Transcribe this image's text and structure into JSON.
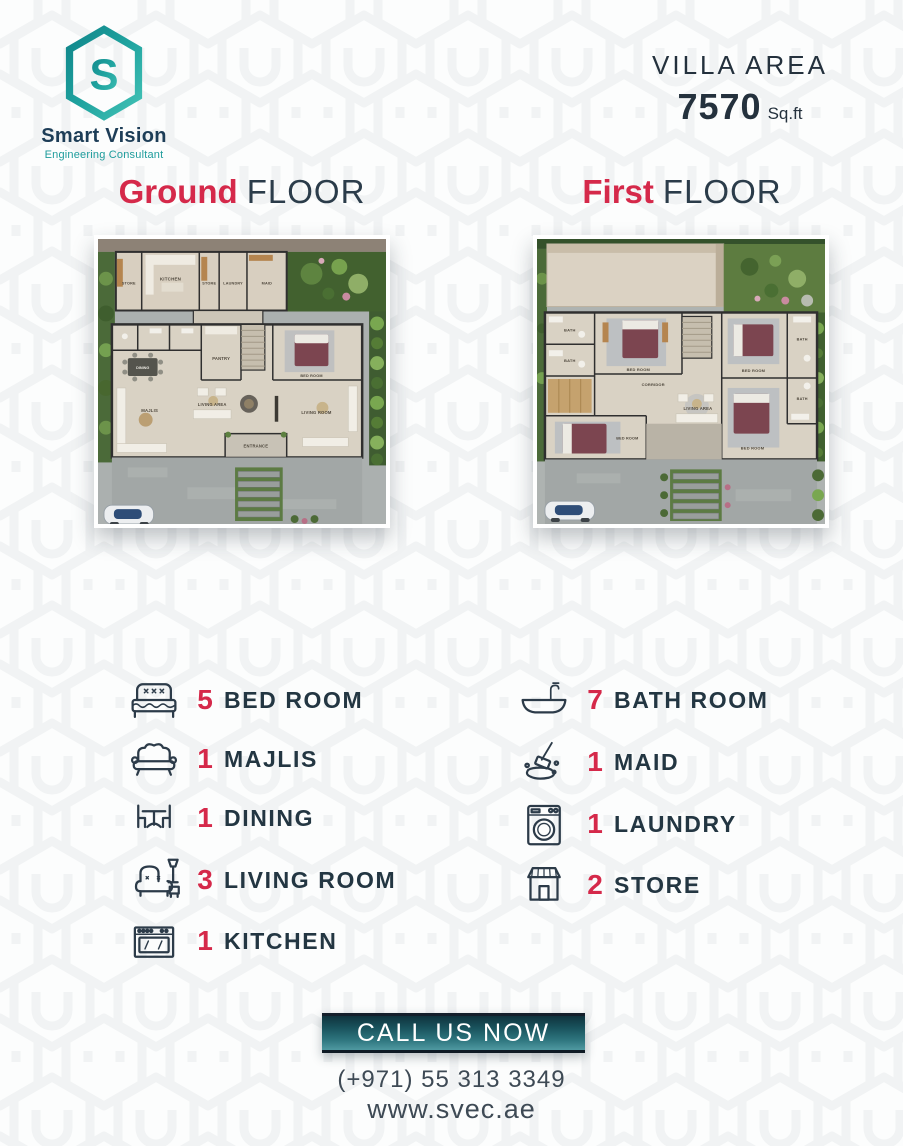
{
  "brand": {
    "name": "Smart Vision",
    "tagline": "Engineering Consultant",
    "logo_letter": "S"
  },
  "header": {
    "area_label": "VILLA AREA",
    "area_value": "7570",
    "area_unit": "Sq.ft"
  },
  "sections": {
    "ground": {
      "highlight": "Ground",
      "rest": "FLOOR"
    },
    "first": {
      "highlight": "First",
      "rest": "FLOOR"
    }
  },
  "ground_plan": {
    "labels": {
      "store_a": "STORE",
      "kitchen": "KITCHEN",
      "store_b": "STORE",
      "laundry": "LAUNDRY",
      "maid": "MAID",
      "pantry": "PANTRY",
      "dining": "DINING",
      "majlis": "MAJLIS",
      "living_area": "LIVING AREA",
      "bed_room": "BED ROOM",
      "living_room": "LIVING ROOM",
      "entrance": "ENTRANCE"
    }
  },
  "first_plan": {
    "labels": {
      "bath_a": "BATH",
      "bath_b": "BATH",
      "bed_top": "BED ROOM",
      "corridor": "CORRIDOR",
      "living_area": "LIVING AREA",
      "bed_right_top": "BED ROOM",
      "bath_c": "BATH",
      "bed_right_bottom": "BED ROOM",
      "bath_d": "BATH",
      "bed_master": "BED ROOM"
    }
  },
  "features_left": [
    {
      "icon": "bed-icon",
      "count": "5",
      "label": "BED ROOM"
    },
    {
      "icon": "sofa-icon",
      "count": "1",
      "label": "MAJLIS"
    },
    {
      "icon": "dining-icon",
      "count": "1",
      "label": "DINING"
    },
    {
      "icon": "armchair-icon",
      "count": "3",
      "label": "LIVING ROOM"
    },
    {
      "icon": "stove-icon",
      "count": "1",
      "label": "KITCHEN"
    }
  ],
  "features_right": [
    {
      "icon": "bathtub-icon",
      "count": "7",
      "label": "BATH ROOM"
    },
    {
      "icon": "cleaning-icon",
      "count": "1",
      "label": "MAID"
    },
    {
      "icon": "washer-icon",
      "count": "1",
      "label": "LAUNDRY"
    },
    {
      "icon": "shop-icon",
      "count": "2",
      "label": "STORE"
    }
  ],
  "cta": {
    "button_label": "CALL US NOW",
    "phone": "(+971) 55 313 3349",
    "website": "www.svec.ae"
  },
  "colors": {
    "accent_red": "#d5294a",
    "navy": "#233642",
    "teal_dark": "#10858a",
    "teal_light": "#43c2b6",
    "button_grad_top": "#0f333d",
    "button_grad_bottom": "#4f99a1"
  }
}
